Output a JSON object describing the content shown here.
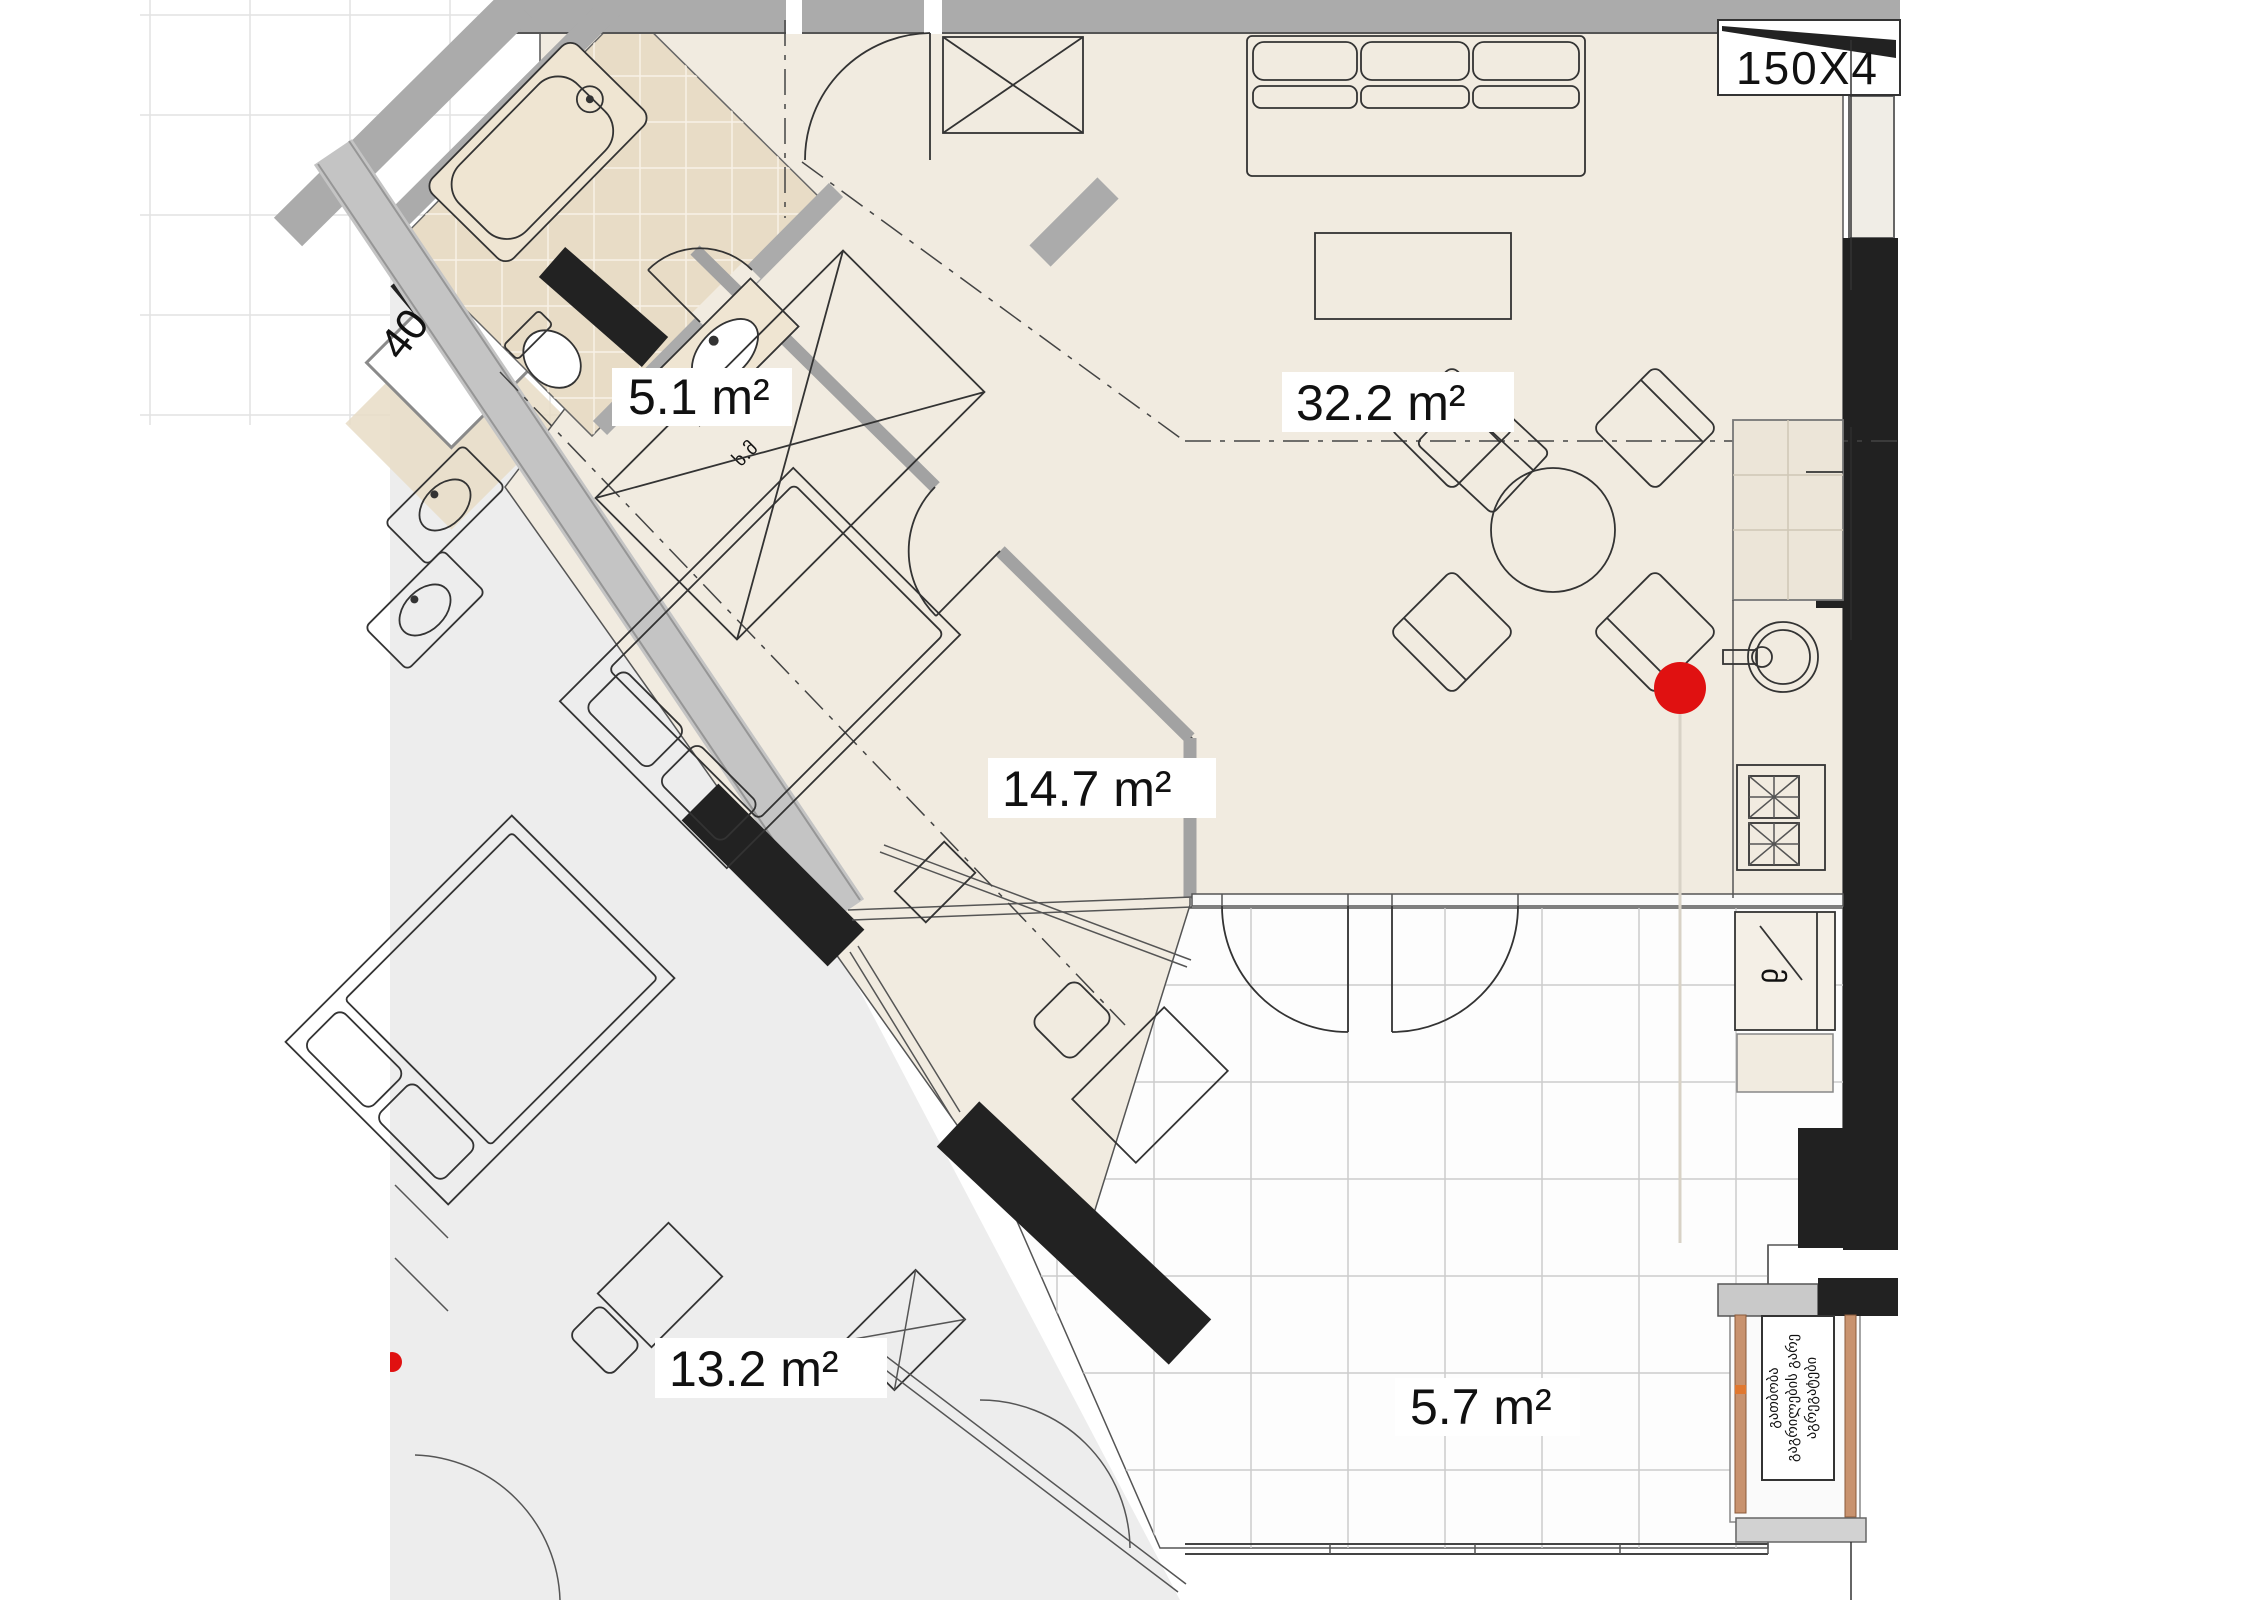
{
  "plan": {
    "rooms": [
      {
        "id": "bathroom",
        "area_label": "5.1 m²"
      },
      {
        "id": "living_room",
        "area_label": "32.2 m²"
      },
      {
        "id": "bedroom",
        "area_label": "14.7 m²"
      },
      {
        "id": "neighbor_bedroom",
        "area_label": "13.2 m²"
      },
      {
        "id": "balcony",
        "area_label": "5.7 m²"
      }
    ],
    "annotations": {
      "window_tag_top_right": "150X4",
      "window_tag_left": "40",
      "bathroom_abbr": "ხ.მ",
      "fridge_letter": "მ",
      "shaft_label_line1": "გათბობა",
      "shaft_label_line2": "გაგრილების გარე",
      "shaft_label_line3": "აგრეგატები"
    },
    "marker": {
      "type": "red-dot",
      "color": "#e01111"
    },
    "colors": {
      "floor_main": "#f1ebe0",
      "floor_bath_tile": "#e8dcc6",
      "floor_neighbor": "#ededed",
      "wall_gray": "#ababab",
      "wall_black": "#222222",
      "louver_tan": "#c8926e"
    }
  }
}
